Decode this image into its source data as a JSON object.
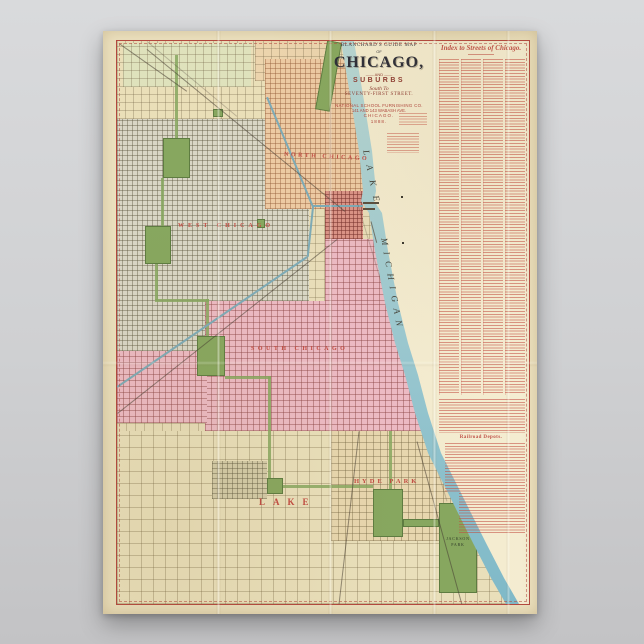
{
  "poster": {
    "title_block": {
      "arc_line": "BLANCHARD'S GUIDE MAP",
      "of_line": "OF",
      "main_title": "CHICAGO,",
      "and_line": "—— AND ——",
      "suburbs_line": "SUBURBS",
      "south_to_line": "South To",
      "street_line": "SEVENTY-FIRST STREET.",
      "publisher_line": "NATIONAL SCHOOL FURNISHING CO.",
      "address_line": "141 AND 143 WABASH AVE.",
      "city_line": "CHICAGO.",
      "year_line": "1888."
    },
    "index_panel": {
      "header": "Index to Streets of Chicago.",
      "railroad_header": "Railroad Depots."
    },
    "map": {
      "water_label_1": "LAKE",
      "water_label_2": "MICHIGAN",
      "district_labels": {
        "north": "NORTH CHICAGO",
        "west": "WEST CHICAGO",
        "south": "SOUTH CHICAGO",
        "lake_town": "LAKE",
        "hyde_park": "HYDE PARK"
      },
      "park_label_jackson": "JACKSON PARK",
      "colors": {
        "water_band": "#9ccdd3",
        "lake_fill": "#f3eacc",
        "park_green": "#87a75f",
        "south_pink": "#ecbac3",
        "north_salmon": "#edcaa3",
        "west_gray": "#d9d6c5",
        "downtown_red": "#da9286",
        "land_tan": "#e8ddb8",
        "border_red": "#b5483f",
        "index_red": "#c05248"
      }
    }
  }
}
